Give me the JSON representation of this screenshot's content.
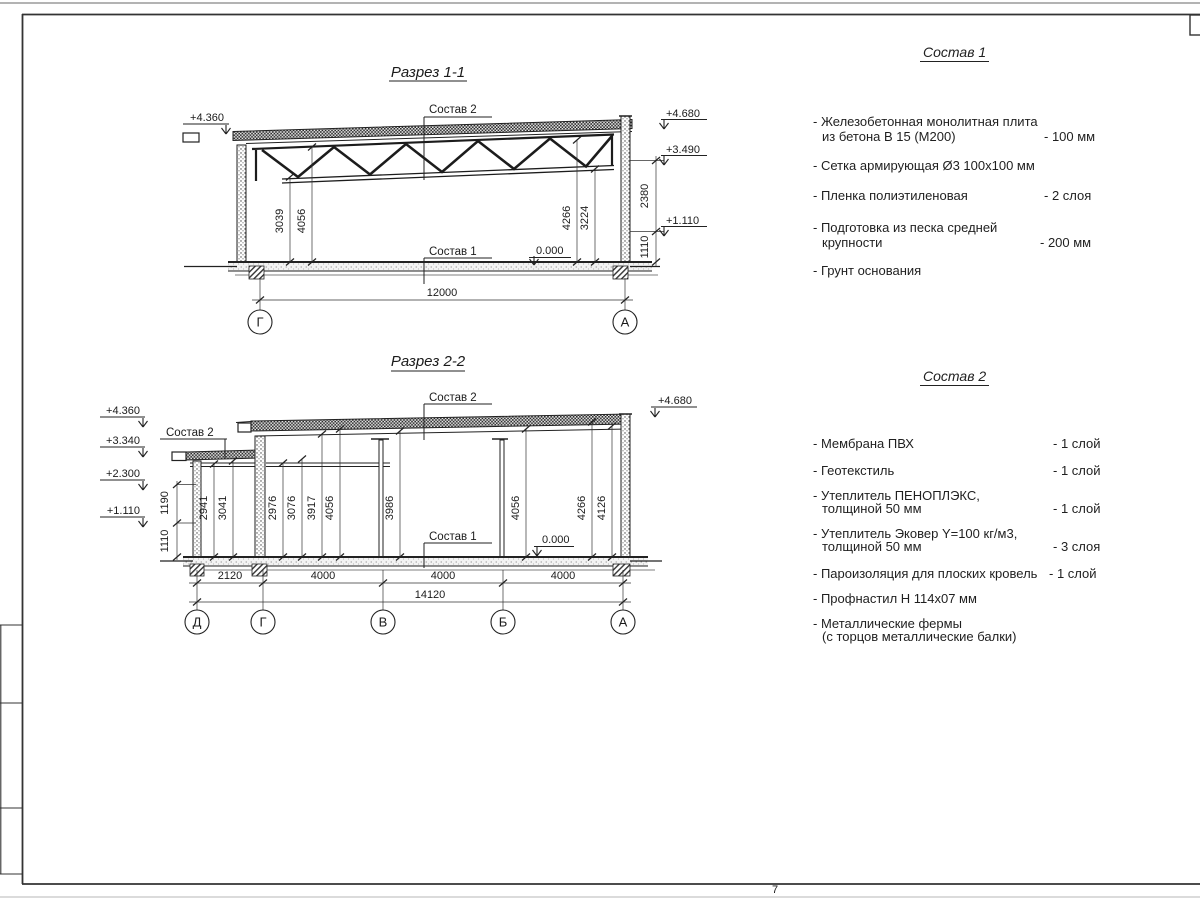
{
  "page": {
    "number": "7"
  },
  "section1": {
    "title": "Разрез 1-1",
    "elev_left": "+4.360",
    "elev_right_top": "+4.680",
    "elev_right_mid": "+3.490",
    "elev_right_low": "+1.110",
    "label_sostav2": "Состав 2",
    "label_sostav1": "Состав 1",
    "label_zero": "0.000",
    "dim_3039": "3039",
    "dim_4056": "4056",
    "dim_4266": "4266",
    "dim_3224": "3224",
    "dim_2380": "2380",
    "dim_1110": "1110",
    "dim_span": "12000",
    "axis_left": "Г",
    "axis_right": "А"
  },
  "section2": {
    "title": "Разрез 2-2",
    "elevs_left": [
      "+4.360",
      "+3.340",
      "+2.300",
      "+1.110"
    ],
    "elev_right": "+4.680",
    "label_sostav2_left": "Состав 2",
    "label_sostav2_top": "Состав 2",
    "label_sostav1": "Состав 1",
    "label_zero": "0.000",
    "wall_dims": [
      "1190",
      "1110"
    ],
    "int_dims": [
      "2941",
      "3041",
      "2976",
      "3076",
      "3917",
      "4056",
      "3986",
      "4056",
      "4266",
      "4126"
    ],
    "bot_dims": [
      "2120",
      "4000",
      "4000",
      "4000"
    ],
    "dim_total": "14120",
    "axes": [
      "Д",
      "Г",
      "В",
      "Б",
      "А"
    ]
  },
  "sostav1": {
    "title": "Состав 1",
    "items": [
      {
        "line1": "- Железобетонная  монолитная плита",
        "line2": "из бетона В 15 (М200)",
        "value": "- 100 мм"
      },
      {
        "line1": "- Сетка армирующая Ø3 100х100 мм",
        "line2": "",
        "value": ""
      },
      {
        "line1": "- Пленка полиэтиленовая",
        "line2": "",
        "value": "-  2 слоя"
      },
      {
        "line1": "- Подготовка из песка средней",
        "line2": "крупности",
        "value": "- 200 мм"
      },
      {
        "line1": "- Грунт основания",
        "line2": "",
        "value": ""
      }
    ]
  },
  "sostav2": {
    "title": "Состав 2",
    "items": [
      {
        "line1": "- Мембрана ПВХ",
        "line2": "",
        "value": "- 1 слой"
      },
      {
        "line1": "- Геотекстиль",
        "line2": "",
        "value": "- 1 слой"
      },
      {
        "line1": "- Утеплитель ПЕНОПЛЭКС,",
        "line2": "толщиной 50 мм",
        "value": "- 1 слой"
      },
      {
        "line1": "- Утеплитель Эковер Y=100 кг/м3,",
        "line2": "толщиной 50 мм",
        "value": "- 3 слоя"
      },
      {
        "line1": "- Пароизоляция для плоских кровель",
        "line2": "",
        "value": "- 1 слой"
      },
      {
        "line1": "- Профнастил Н 114х07 мм",
        "line2": "",
        "value": ""
      },
      {
        "line1": "- Металлические фермы",
        "line2": "(с торцов металлические балки)",
        "value": ""
      }
    ]
  }
}
